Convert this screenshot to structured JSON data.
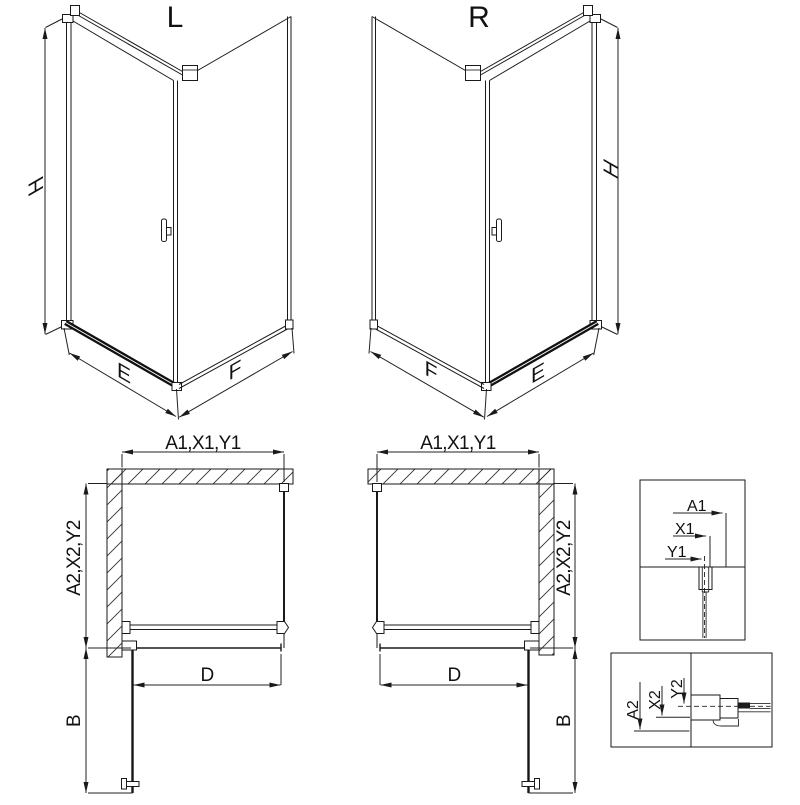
{
  "views": {
    "iso_left": {
      "label": "L",
      "h": "H",
      "e": "E",
      "f": "F"
    },
    "iso_right": {
      "label": "R",
      "h": "H",
      "e": "E",
      "f": "F"
    },
    "plan_left": {
      "width": "A1,X1,Y1",
      "depth": "A2,X2,Y2",
      "door": "D",
      "swing": "B"
    },
    "plan_right": {
      "width": "A1,X1,Y1",
      "depth": "A2,X2,Y2",
      "door": "D",
      "swing": "B"
    },
    "detail_width": {
      "a": "A1",
      "x": "X1",
      "y": "Y1"
    },
    "detail_depth": {
      "a": "A2",
      "x": "X2",
      "y": "Y2"
    }
  },
  "colors": {
    "line": "#1a1a1a",
    "background": "#ffffff"
  }
}
